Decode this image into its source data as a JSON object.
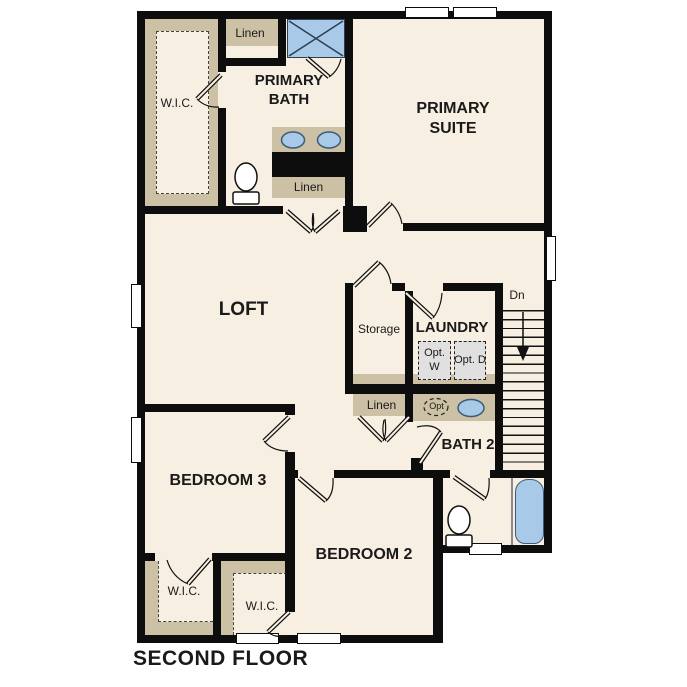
{
  "floor_title": "SECOND FLOOR",
  "rooms": {
    "primary_suite": "PRIMARY SUITE",
    "primary_bath": "PRIMARY BATH",
    "loft": "LOFT",
    "laundry": "LAUNDRY",
    "bath2": "BATH 2",
    "bedroom2": "BEDROOM 2",
    "bedroom3": "BEDROOM 3"
  },
  "closets": {
    "wic_primary": "W.I.C.",
    "wic_bedroom3": "W.I.C.",
    "wic_bedroom2": "W.I.C.",
    "linen_upper": "Linen",
    "linen_primary_bath": "Linen",
    "linen_hall": "Linen",
    "storage": "Storage"
  },
  "stairs": {
    "direction_label": "Dn"
  },
  "optional_fixtures": {
    "washer": "Opt. W",
    "dryer": "Opt. D",
    "sink": "Opt"
  },
  "colors": {
    "wall": "#0d0d0d",
    "floor": "#f7efe2",
    "closet_tan": "#ccc0a5",
    "fixture_blue": "#a9c9e9",
    "fixture_outline": "#3f5a77",
    "optional_gray": "#e0e0e0",
    "page_background": "#ffffff"
  }
}
